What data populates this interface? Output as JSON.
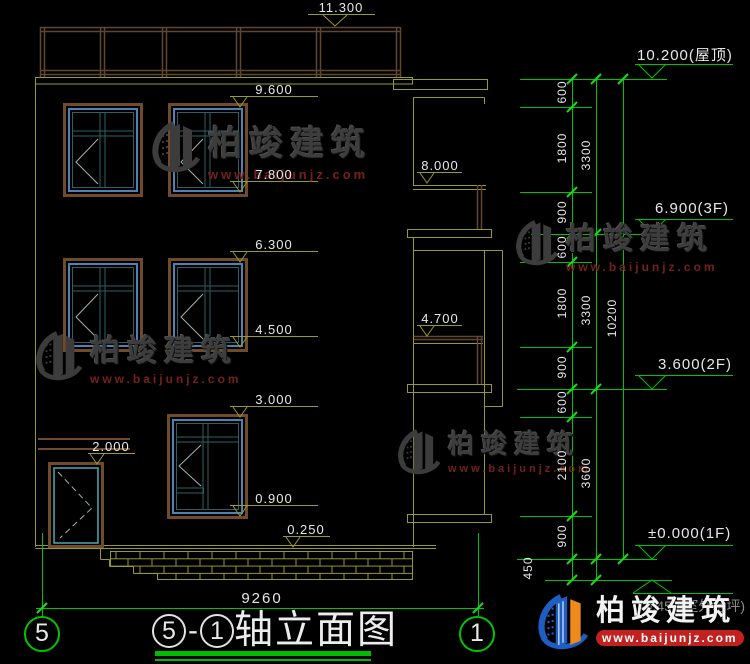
{
  "markers": {
    "parapet": "11.300",
    "w3_top": "9.600",
    "w3_bot": "7.800",
    "roof_balcony": "8.000",
    "w2_top": "6.300",
    "w2_bot": "4.500",
    "balcony2": "4.700",
    "w1_top": "3.000",
    "w1_bot": "0.900",
    "canopy": "2.000",
    "plinth": "0.250"
  },
  "levels": {
    "roof": "10.200(屋顶)",
    "f3": "6.900(3F)",
    "f2": "3.600(2F)",
    "f1": "±0.000(1F)",
    "outdoor": "-0.450(室外地坪)"
  },
  "chain": {
    "col1": [
      "600",
      "1800",
      "900",
      "600",
      "1800",
      "900",
      "600",
      "2100",
      "900",
      "450"
    ],
    "col2": [
      "3300",
      "3300",
      "3600"
    ],
    "col3": [
      "10200"
    ]
  },
  "footer": {
    "total_width": "9260"
  },
  "axes": {
    "left": "5",
    "right": "1"
  },
  "title": {
    "axis_a": "5",
    "sep": "-",
    "axis_b": "1",
    "name": "轴立面图"
  },
  "brand": {
    "name": "柏竣建筑",
    "site": "www.baijunjz.com"
  },
  "colors": {
    "line_olive": "#98992b",
    "line_green": "#00c400",
    "frame_brown": "#6f4a2b",
    "frame_blue": "#4e82b4",
    "watermark_red": "#76201c",
    "logo_blue": "#1e5ec2",
    "logo_orange": "#ef8b1c",
    "logo_band_red": "#c32020"
  }
}
